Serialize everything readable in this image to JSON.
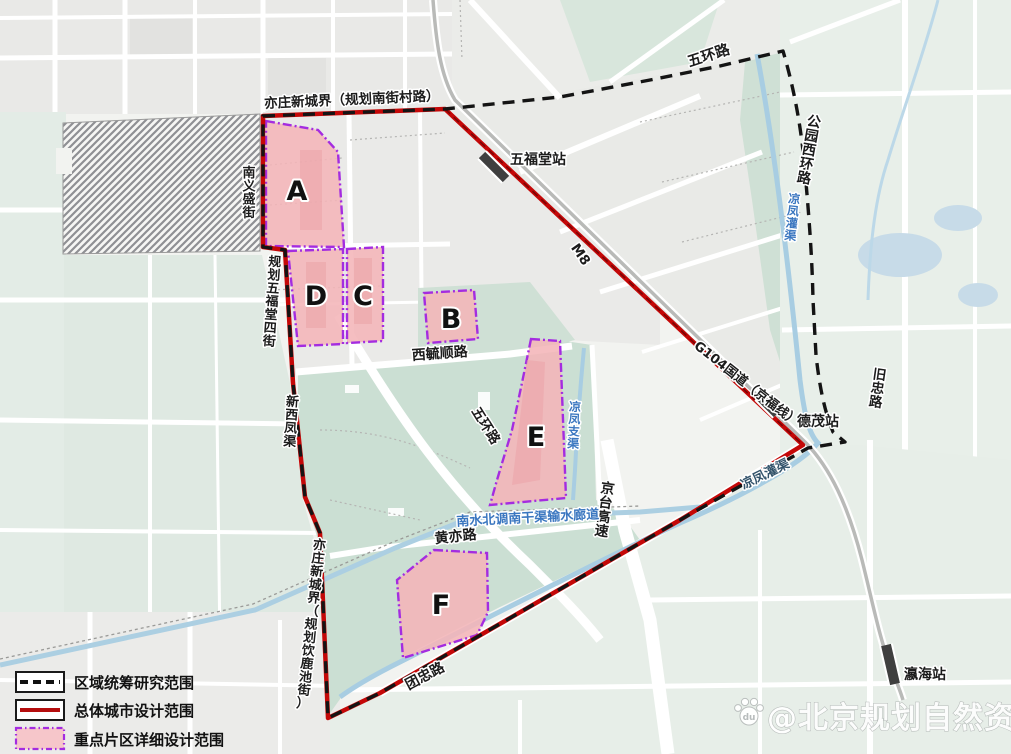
{
  "legend": {
    "items": [
      {
        "label": "区域统筹研究范围",
        "style": "black-dashed-line"
      },
      {
        "label": "总体城市设计范围",
        "style": "red-solid-line"
      },
      {
        "label": "重点片区详细设计范围",
        "style": "pink-purple-dashed-box"
      }
    ]
  },
  "zones": {
    "a": "A",
    "b": "B",
    "c": "C",
    "d": "D",
    "e": "E",
    "f": "F"
  },
  "stations": {
    "wufutang": "五福堂站",
    "demao": "德茂站",
    "yinghai": "瀛海站"
  },
  "boundaries": {
    "north": "亦庄新城界（规划南街村路）",
    "south": "亦庄新城界（规划饮鹿池街）"
  },
  "roads": {
    "wuhuan_north": "五环路",
    "wuhuan_central": "五环路",
    "gongyuan_xihuan": "公园西环路",
    "nanyisheng": "南义盛街",
    "wufutang_4th": "规划五福堂四街",
    "xiyushun": "西毓顺路",
    "huangyi": "黄亦路",
    "tuanzhong": "团忠路",
    "jingtai_expwy": "京台高速",
    "jiuzhong": "旧忠路",
    "g104": "G104国道（京福线）",
    "m8": "M8"
  },
  "waterways": {
    "liangfeng_guanqu_ne": "凉凤灌渠",
    "liangfeng_guanqu_sw": "凉凤灌渠",
    "liangfeng_zhiqu": "凉凤支渠",
    "xinxifeng": "新西凤渠",
    "nanshuibeidiao": "南水北调南干渠输水廊道"
  },
  "watermark": {
    "handle": "@北京规划自然资源",
    "icon_text": "du"
  },
  "colors": {
    "design_boundary_red": "#c40808",
    "research_boundary_black": "#141414",
    "zone_border_purple": "#a42ce0",
    "zone_fill_pink": "#f4b5b8",
    "water_blue": "#a8cde2",
    "water_label_blue": "#3b77c0",
    "park_green": "#cbdfd3",
    "block_grey": "#e9e9e7",
    "rail_grey": "#b9bab8"
  }
}
